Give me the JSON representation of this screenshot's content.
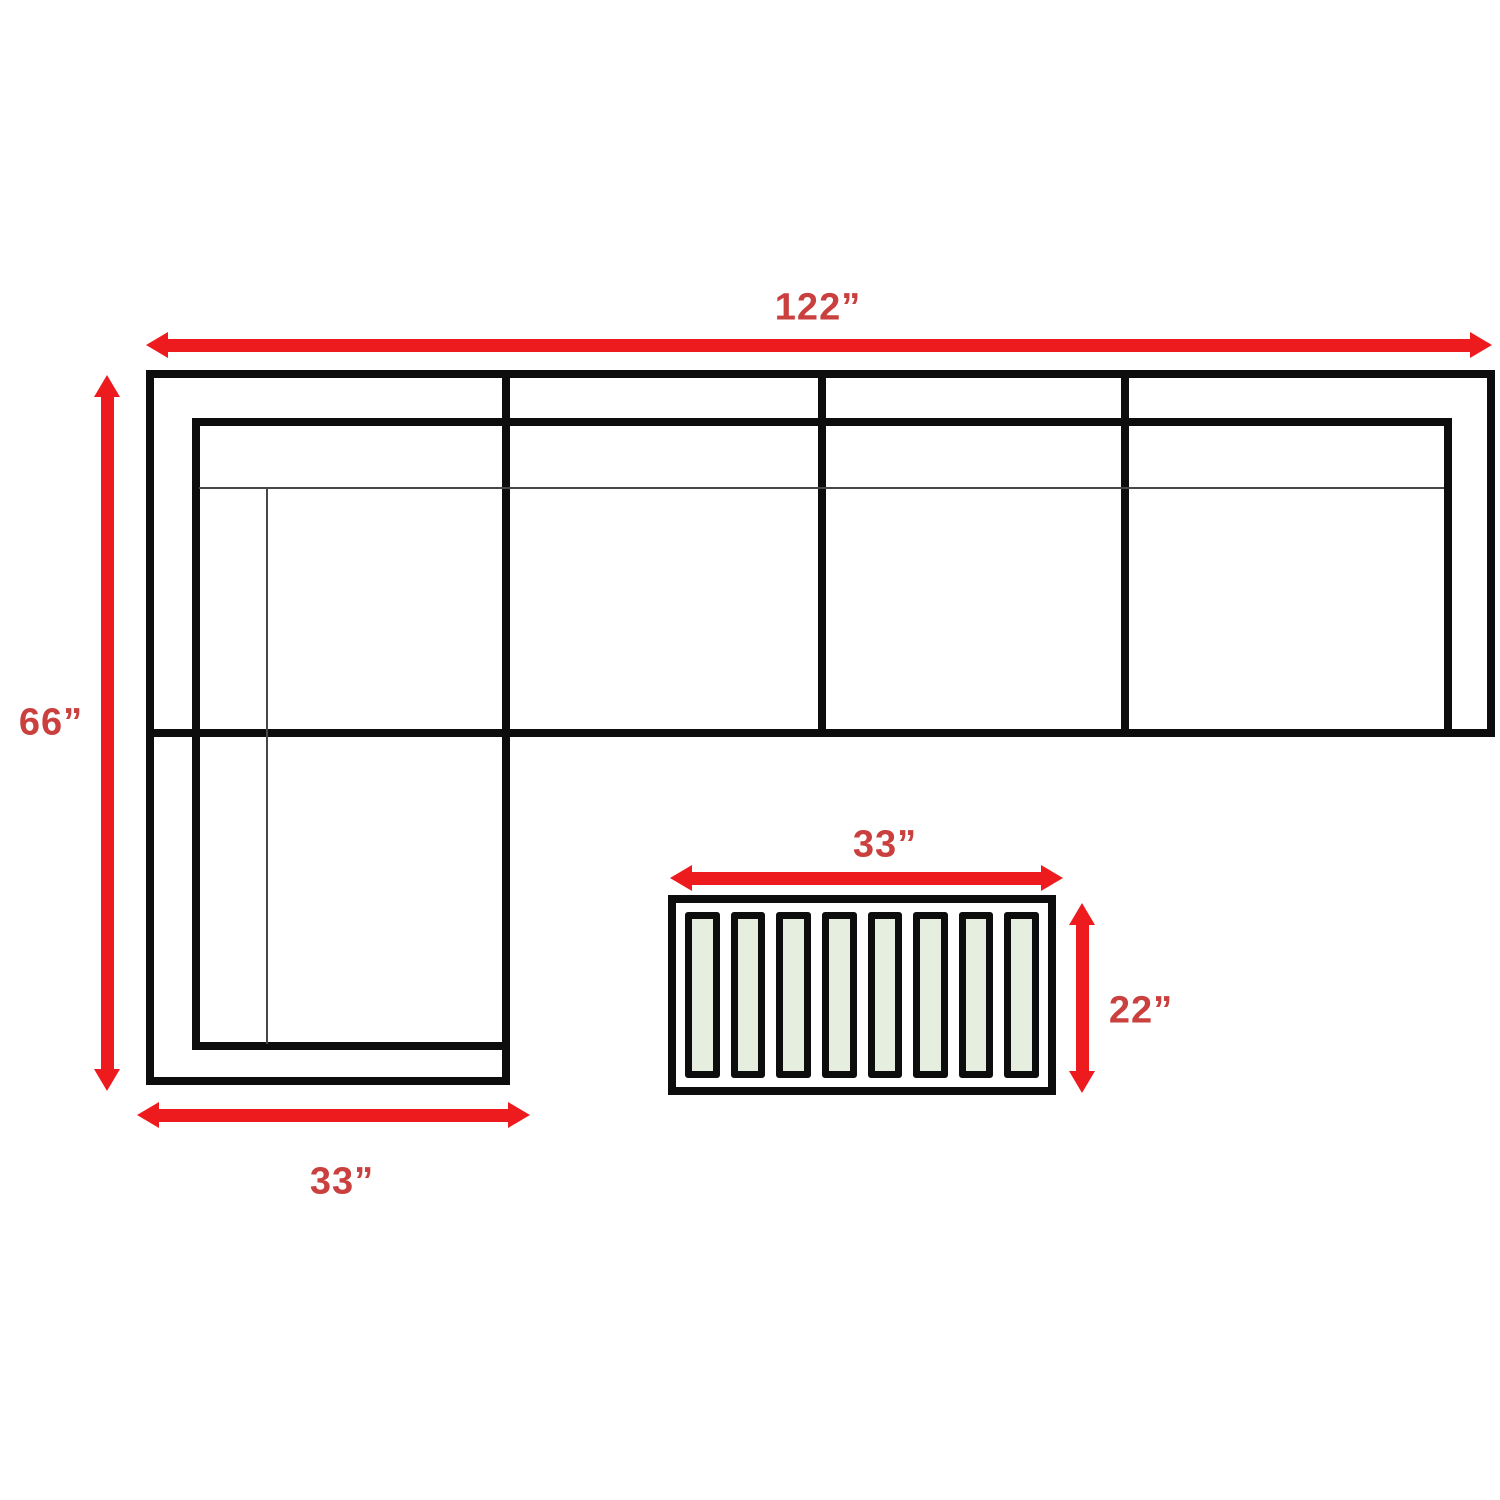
{
  "diagram": {
    "sofa": {
      "width_label": "122”",
      "depth_label": "66”",
      "chaise_width_label": "33”",
      "seat_sections": 4
    },
    "table": {
      "width_label": "33”",
      "depth_label": "22”",
      "slat_count": 8
    }
  },
  "colors": {
    "arrow_red": "#ee1b1e",
    "label_red": "#c9403f",
    "line_black": "#0d0d0d",
    "slat_green": "#e6efdf",
    "background": "#ffffff"
  }
}
